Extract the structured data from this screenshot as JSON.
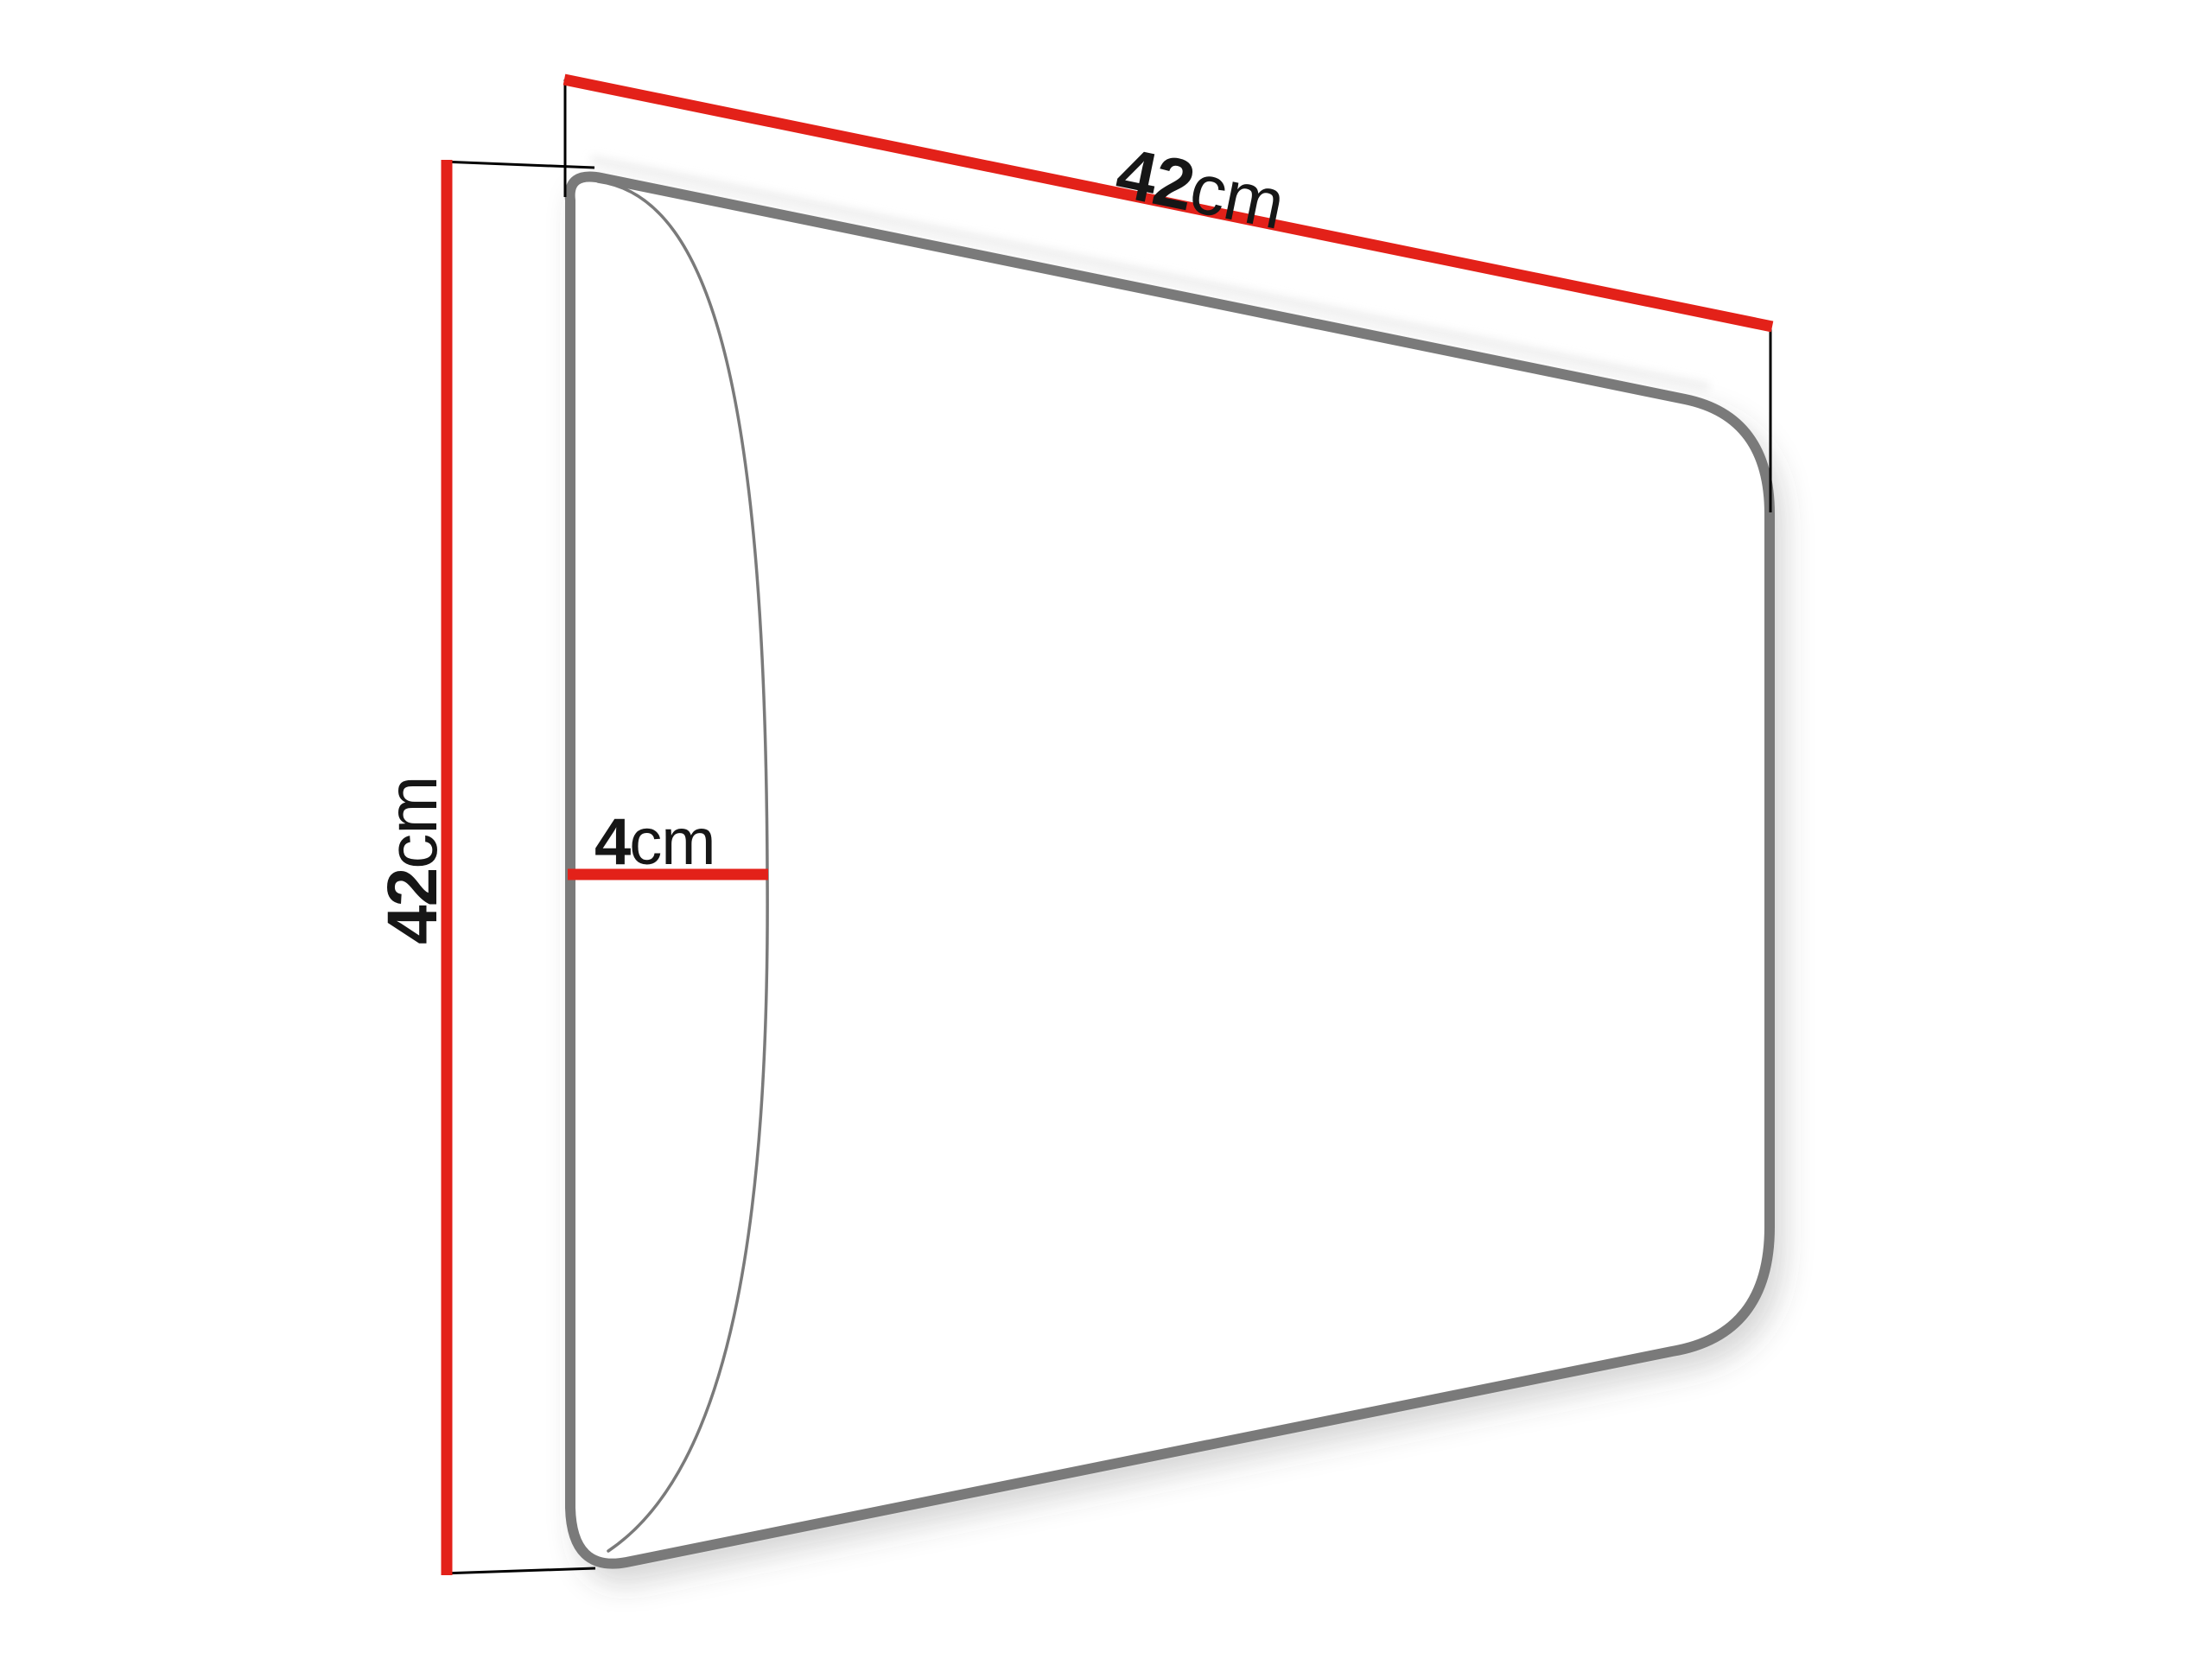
{
  "diagram": {
    "type": "product-dimension-diagram",
    "subject": "upholstered wall panel shown in perspective",
    "labels": {
      "width": {
        "value": "42",
        "unit": "cm"
      },
      "height": {
        "value": "42",
        "unit": "cm"
      },
      "depth": {
        "value": "4",
        "unit": "cm"
      }
    },
    "colors": {
      "dimension_line": "#e32119",
      "panel_outline": "#7a7a7a",
      "extension_line": "#000000",
      "label_text": "#161616",
      "background": "#ffffff"
    }
  }
}
